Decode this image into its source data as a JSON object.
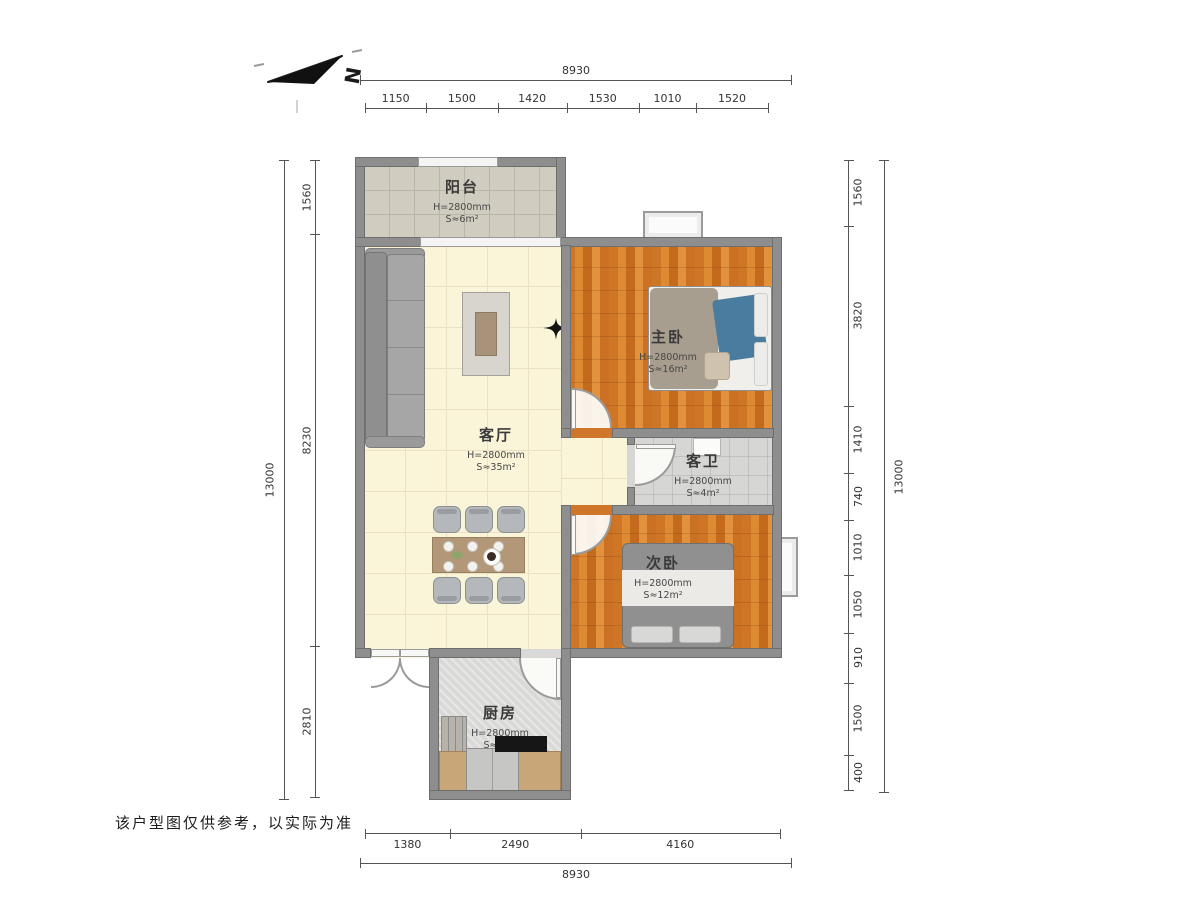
{
  "compass": {
    "label": "N"
  },
  "footer": {
    "disclaimer": "该户型图仅供参考，以实际为准"
  },
  "dimensions": {
    "top": {
      "total": "8930",
      "segments": [
        "1150",
        "1500",
        "1420",
        "1530",
        "1010",
        "1520"
      ]
    },
    "bottom": {
      "total": "8930",
      "segments": [
        "1380",
        "2490",
        "4160"
      ]
    },
    "left": {
      "total": "13000",
      "segments": [
        "1560",
        "8230",
        "2810"
      ]
    },
    "right": {
      "total": "13000",
      "segments": [
        "1560",
        "3820",
        "1410",
        "740",
        "1010",
        "1050",
        "910",
        "1500",
        "400"
      ]
    }
  },
  "rooms": {
    "balcony": {
      "name": "阳台",
      "ceiling": "H=2800mm",
      "area": "S≈6m²"
    },
    "living": {
      "name": "客厅",
      "ceiling": "H=2800mm",
      "area": "S≈35m²"
    },
    "master": {
      "name": "主卧",
      "ceiling": "H=2800mm",
      "area": "S≈16m²"
    },
    "bathroom": {
      "name": "客卫",
      "ceiling": "H=2800mm",
      "area": "S≈4m²"
    },
    "second": {
      "name": "次卧",
      "ceiling": "H=2800mm",
      "area": "S≈12m²"
    },
    "kitchen": {
      "name": "厨房",
      "ceiling": "H=2800mm",
      "area": "S≈7m²"
    }
  },
  "colors": {
    "wall": "#8e8e8e",
    "wood_floor": "#d0762a",
    "living_floor": "#faf5d9",
    "tile_floor": "#d6d6d4",
    "counter": "#c9a678",
    "accent_blue": "#4a7c9f"
  }
}
